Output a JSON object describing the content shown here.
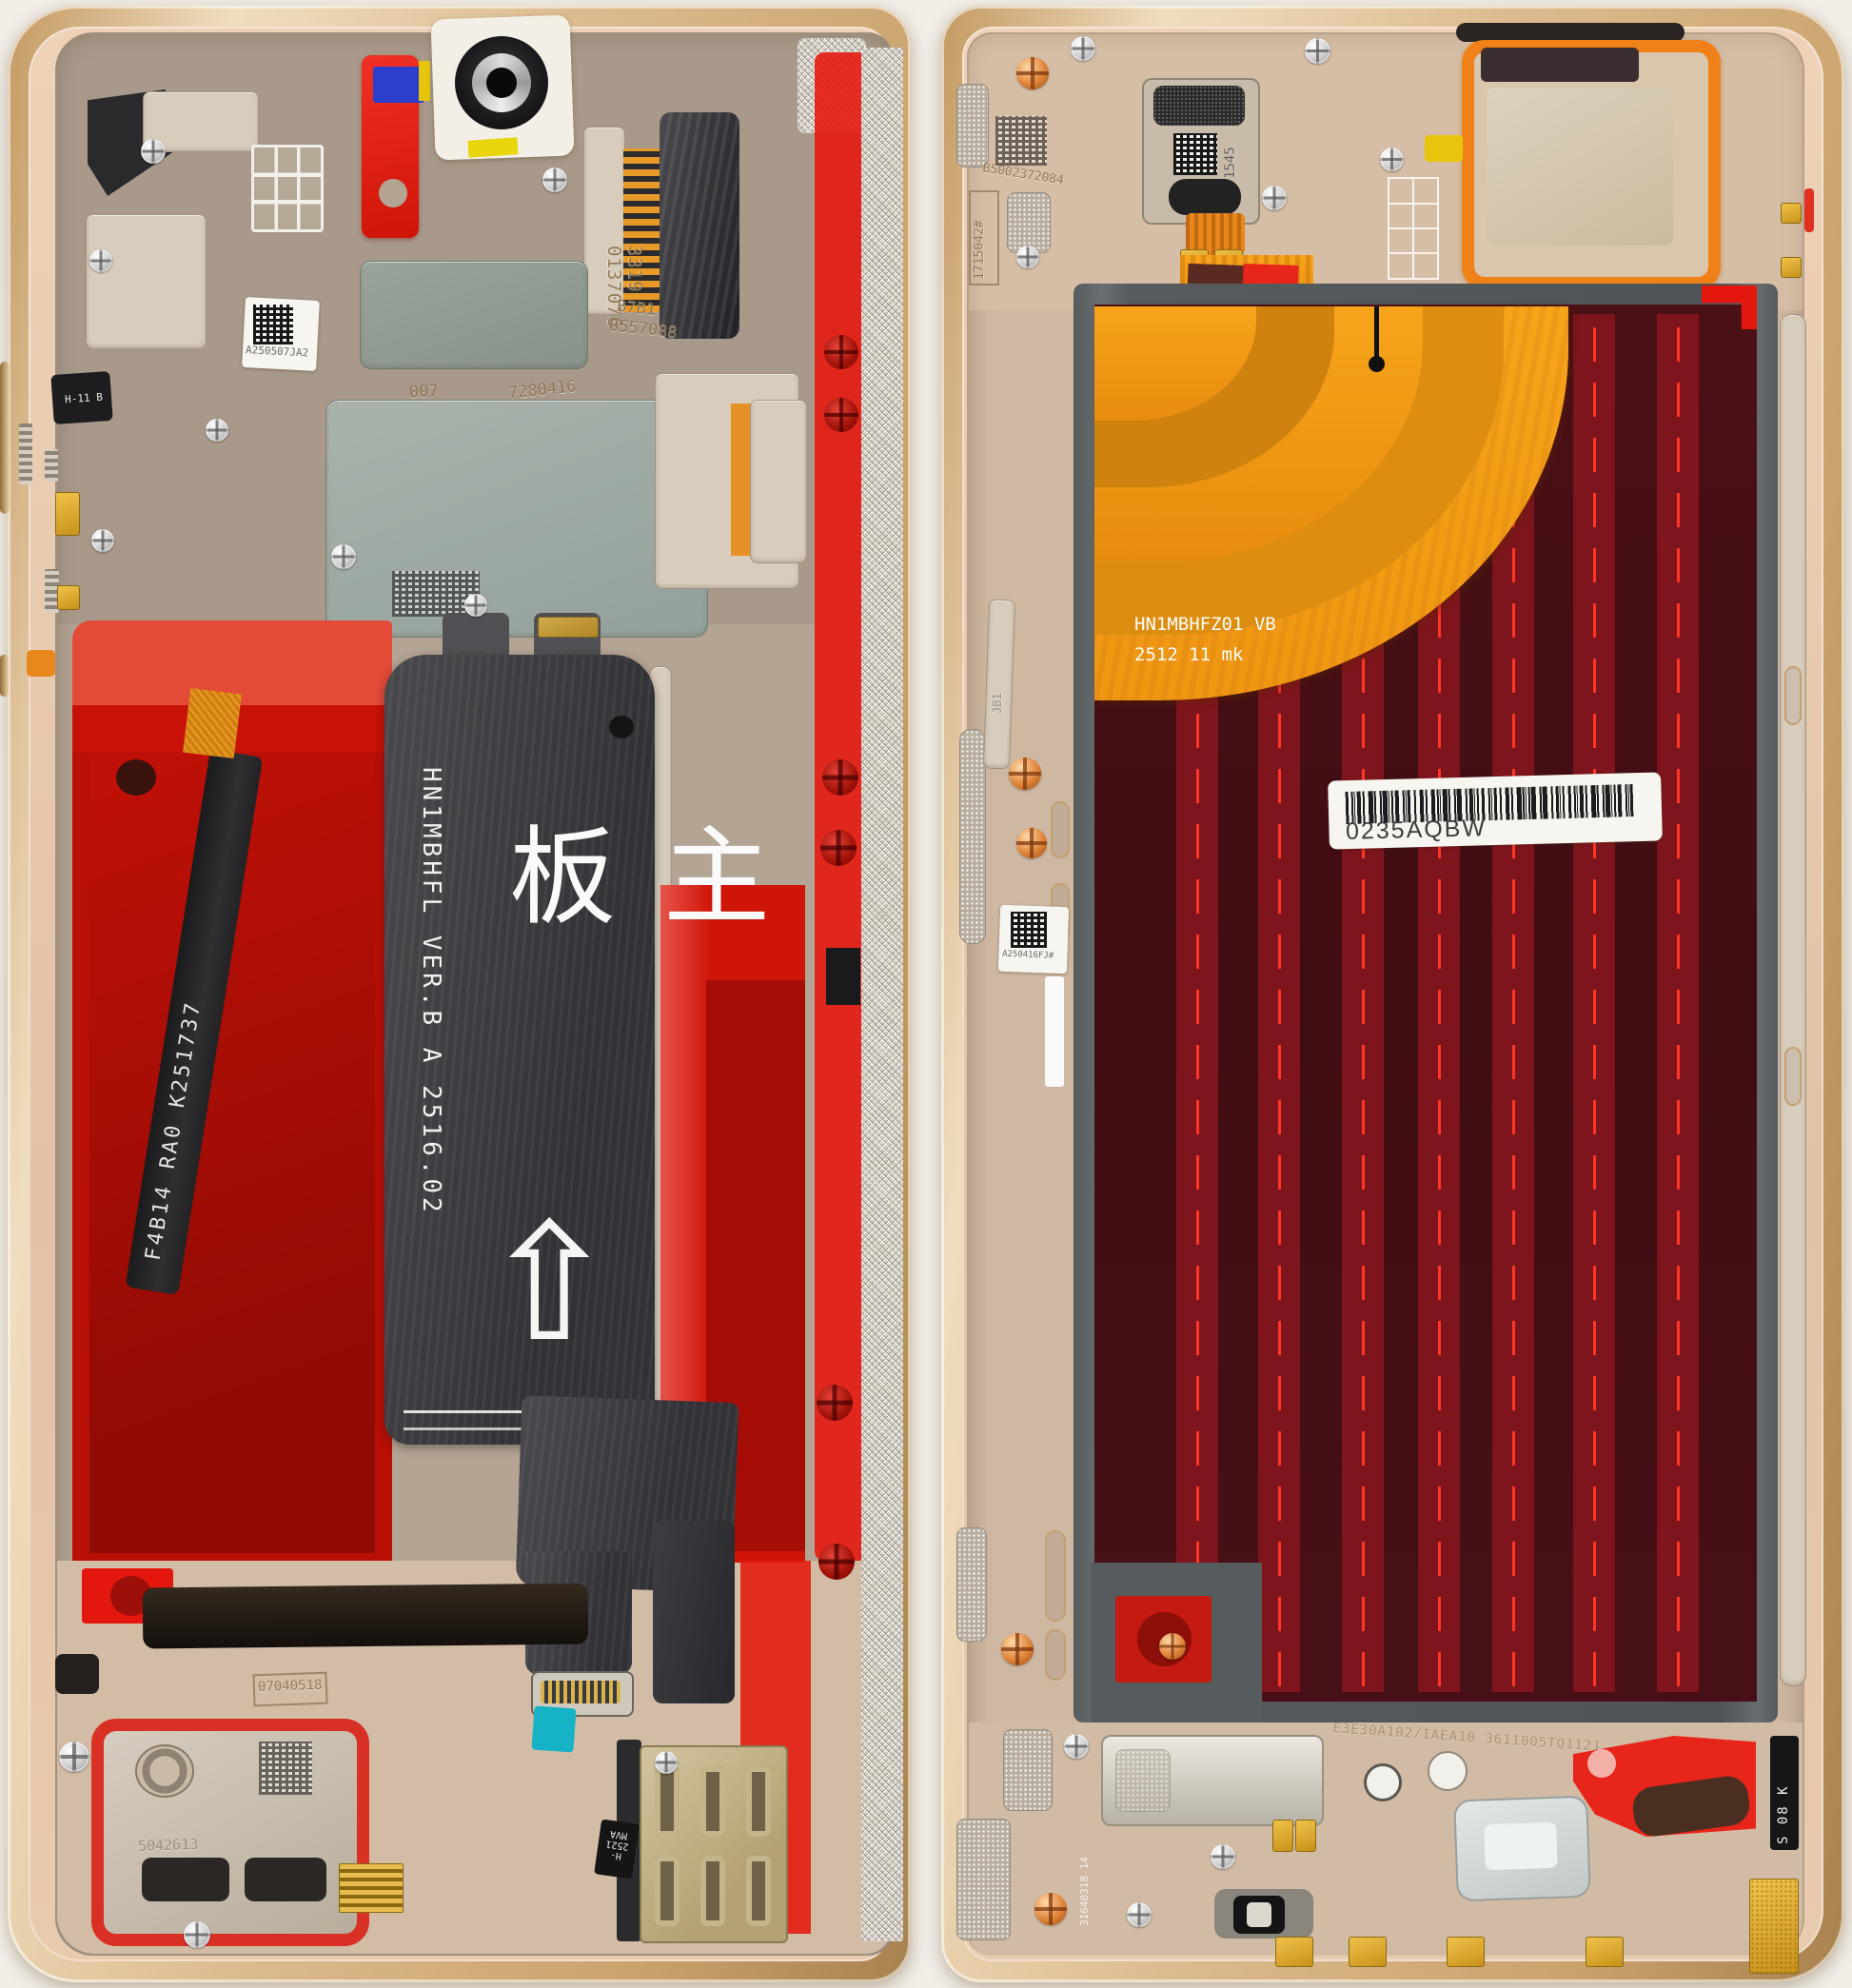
{
  "scene": {
    "subject": "foldable phone disassembled halves, internal view",
    "left": {
      "qr_label": "A250507JA2",
      "etch_col": "3319 0137076",
      "etch_b7b1": "B7B1",
      "etch_0557088": "0557088",
      "etch_007": "007",
      "etch_7280416": "7280416",
      "etch_17vn2d": "17VN2D",
      "battery_flex_code": "F4B14 RA0 K251737",
      "side_flex_code": "H-11 B",
      "mainboard_code": "HN1MBHFL VER.B A 2516.02",
      "mainboard_cjk": "主板",
      "mainboard_arrow": "⇧",
      "bottom_box_code": "07040518",
      "speaker_etch": "5042613",
      "sim_flex_line1": "MVA",
      "sim_flex_line2": "H-2521"
    },
    "right": {
      "qr_top_code": "B5002372084",
      "vertical_box_code": "1715042#",
      "earpiece_etch": "1545",
      "orange_flex_line1": "HN1MBHFZ01 VB",
      "orange_flex_line2": "2512 11  mk",
      "barcode_text": "0235AQBW",
      "qr_left_code": "A250416FJ#",
      "bracket_etch": "JB1",
      "bottom_etch": "E3E30A102/IAEA10 3611005TQ1121",
      "bottom_vertical_etch": "31640318 14",
      "corner_code": "S 08 K"
    },
    "colors": {
      "gold_frame": "#d9b98c",
      "deck_pink": "#e6c9ae",
      "adhesive_red": "#c81208",
      "hinge_strip_red": "#e3170d",
      "panel_maroon": "#451016",
      "panel_stripe": "#7e151c",
      "stripe_line": "#ff3527",
      "flex_orange": "#f59a12",
      "tape_cyan": "#16b3c6",
      "tape_blue": "#2b3fcc",
      "tape_yellow": "#e7c50c",
      "flex_black": "#3c3c40"
    }
  }
}
